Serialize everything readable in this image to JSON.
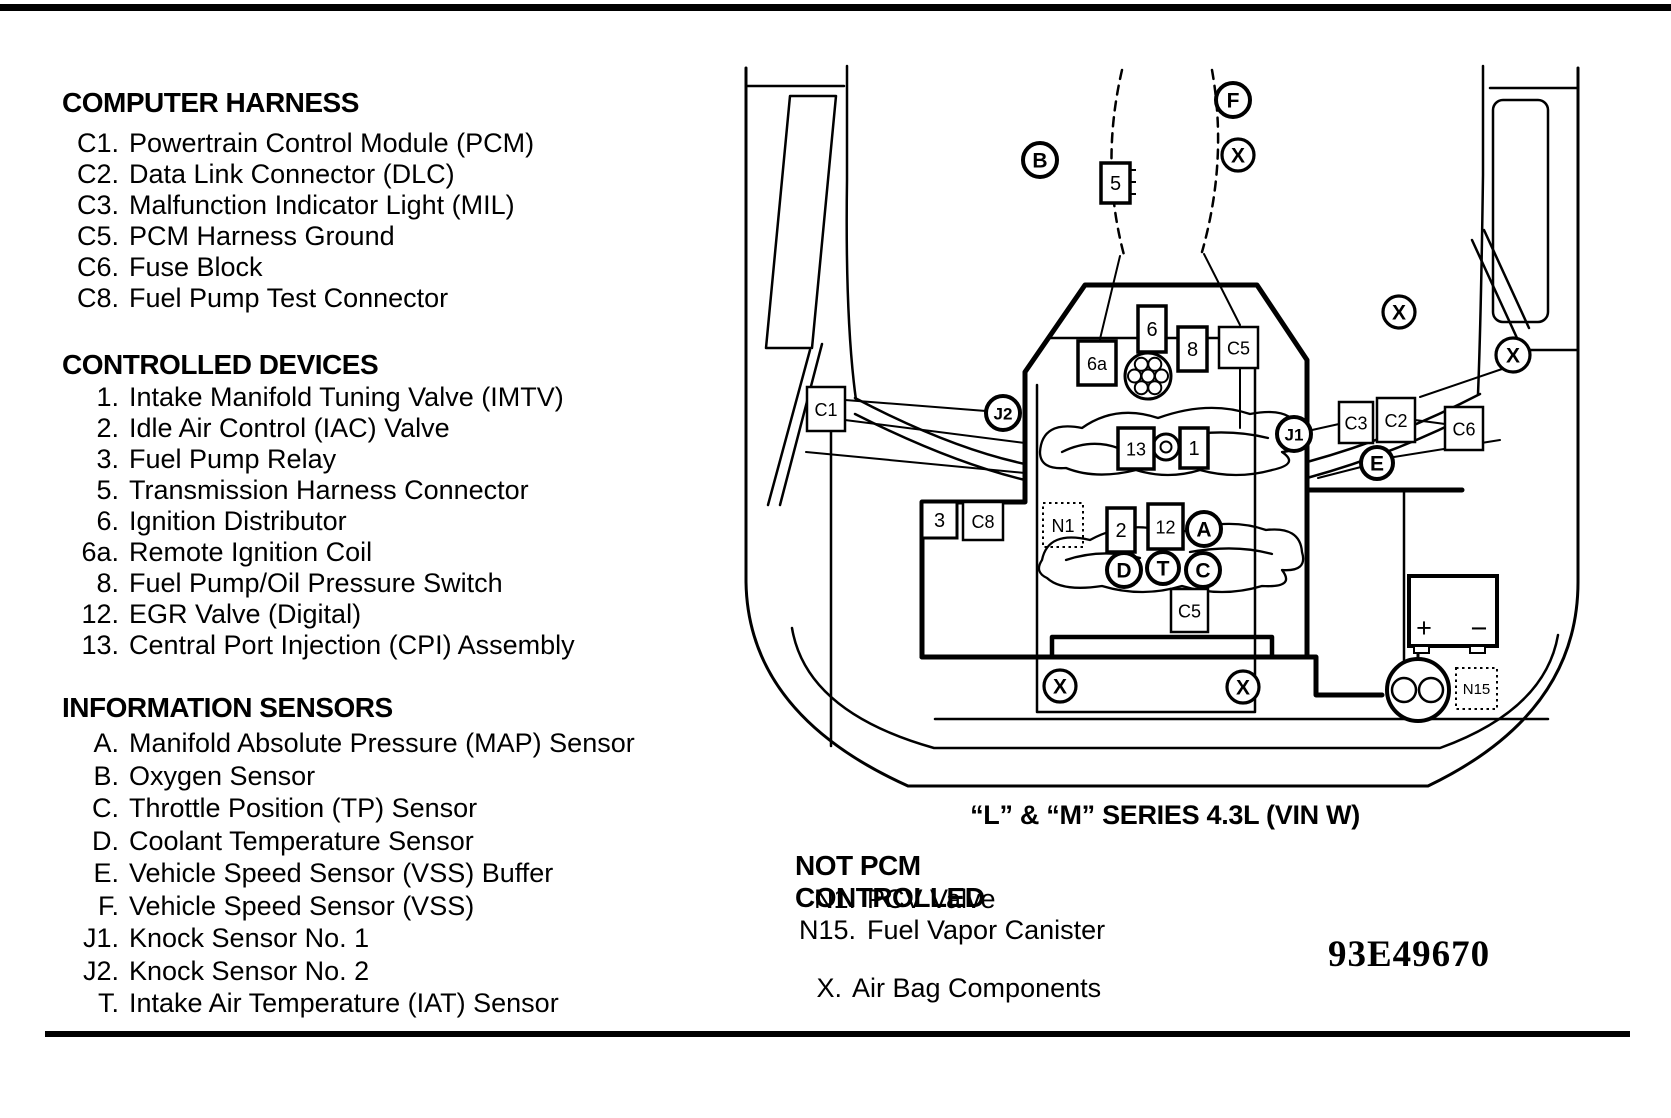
{
  "ink_color": "#000000",
  "paper_color": "#ffffff",
  "legend_left": {
    "sections": [
      {
        "title": "COMPUTER HARNESS",
        "items": [
          {
            "code": "C1.",
            "label": "Powertrain Control Module (PCM)"
          },
          {
            "code": "C2.",
            "label": "Data Link Connector (DLC)"
          },
          {
            "code": "C3.",
            "label": "Malfunction Indicator Light (MIL)"
          },
          {
            "code": "C5.",
            "label": "PCM Harness Ground"
          },
          {
            "code": "C6.",
            "label": "Fuse Block"
          },
          {
            "code": "C8.",
            "label": "Fuel Pump Test Connector"
          }
        ]
      },
      {
        "title": "CONTROLLED DEVICES",
        "items": [
          {
            "code": "1.",
            "label": "Intake Manifold Tuning Valve (IMTV)"
          },
          {
            "code": "2.",
            "label": "Idle Air Control (IAC) Valve"
          },
          {
            "code": "3.",
            "label": "Fuel Pump Relay"
          },
          {
            "code": "5.",
            "label": "Transmission Harness Connector"
          },
          {
            "code": "6.",
            "label": "Ignition Distributor"
          },
          {
            "code": "6a.",
            "label": "Remote Ignition Coil"
          },
          {
            "code": "8.",
            "label": "Fuel Pump/Oil Pressure Switch"
          },
          {
            "code": "12.",
            "label": "EGR Valve (Digital)"
          },
          {
            "code": "13.",
            "label": "Central Port Injection (CPI) Assembly"
          }
        ]
      },
      {
        "title": "INFORMATION SENSORS",
        "items": [
          {
            "code": "A.",
            "label": "Manifold Absolute Pressure (MAP) Sensor"
          },
          {
            "code": "B.",
            "label": "Oxygen Sensor"
          },
          {
            "code": "C.",
            "label": "Throttle Position (TP) Sensor"
          },
          {
            "code": "D.",
            "label": "Coolant Temperature Sensor"
          },
          {
            "code": "E.",
            "label": "Vehicle Speed Sensor (VSS) Buffer"
          },
          {
            "code": "F.",
            "label": "Vehicle Speed Sensor (VSS)"
          },
          {
            "code": "J1.",
            "label": "Knock Sensor No. 1"
          },
          {
            "code": "J2.",
            "label": "Knock Sensor No. 2"
          },
          {
            "code": "T.",
            "label": "Intake Air Temperature (IAT) Sensor"
          }
        ]
      }
    ]
  },
  "caption": "“L” & “M” SERIES 4.3L (VIN W)",
  "not_pcm": {
    "title": "NOT PCM CONTROLLED",
    "items": [
      {
        "code": "N1.",
        "label": "PCV Valve"
      },
      {
        "code": "N15.",
        "label": "Fuel Vapor Canister"
      }
    ],
    "airbag": {
      "code": "X.",
      "label": "Air Bag Components"
    }
  },
  "figure_number": "93E49670",
  "diagram": {
    "battery": {
      "plus": "+",
      "minus": "−"
    },
    "boxes": [
      {
        "label": "5",
        "x": 1101,
        "y": 163,
        "w": 29,
        "h": 40,
        "sw": 3.5
      },
      {
        "label": "6",
        "x": 1138,
        "y": 306,
        "w": 28,
        "h": 46,
        "sw": 3.5
      },
      {
        "label": "8",
        "x": 1178,
        "y": 327,
        "w": 29,
        "h": 44,
        "sw": 3.5
      },
      {
        "label": "C5",
        "x": 1219,
        "y": 327,
        "w": 39,
        "h": 41,
        "sw": 2.5
      },
      {
        "label": "6a",
        "x": 1078,
        "y": 341,
        "w": 38,
        "h": 44,
        "sw": 3.5
      },
      {
        "label": "C1",
        "x": 807,
        "y": 387,
        "w": 38,
        "h": 44,
        "sw": 2.5
      },
      {
        "label": "13",
        "x": 1118,
        "y": 428,
        "w": 36,
        "h": 41,
        "sw": 3.5
      },
      {
        "label": "1",
        "x": 1180,
        "y": 428,
        "w": 28,
        "h": 40,
        "sw": 3.5
      },
      {
        "label": "C3",
        "x": 1339,
        "y": 402,
        "w": 34,
        "h": 41,
        "sw": 2.5
      },
      {
        "label": "C2",
        "x": 1377,
        "y": 398,
        "w": 38,
        "h": 44,
        "sw": 2.5
      },
      {
        "label": "C6",
        "x": 1445,
        "y": 407,
        "w": 38,
        "h": 43,
        "sw": 2.5
      },
      {
        "label": "3",
        "x": 922,
        "y": 502,
        "w": 35,
        "h": 36,
        "sw": 3
      },
      {
        "label": "C8",
        "x": 963,
        "y": 502,
        "w": 40,
        "h": 38,
        "sw": 2.5
      },
      {
        "label": "2",
        "x": 1107,
        "y": 508,
        "w": 28,
        "h": 44,
        "sw": 3.5
      },
      {
        "label": "12",
        "x": 1148,
        "y": 504,
        "w": 35,
        "h": 45,
        "sw": 3.5
      },
      {
        "label": "C5",
        "x": 1171,
        "y": 589,
        "w": 37,
        "h": 43,
        "sw": 2.5
      }
    ],
    "dotted_boxes": [
      {
        "label": "N1",
        "x": 1043,
        "y": 503,
        "w": 40,
        "h": 44
      },
      {
        "label": "N15",
        "x": 1456,
        "y": 668,
        "w": 41,
        "h": 41
      }
    ],
    "circles": [
      {
        "label": "B",
        "x": 1040,
        "y": 160,
        "r": 17,
        "sw": 4
      },
      {
        "label": "F",
        "x": 1233,
        "y": 100,
        "r": 17,
        "sw": 4
      },
      {
        "label": "X",
        "x": 1238,
        "y": 155,
        "r": 16,
        "sw": 3.2
      },
      {
        "label": "X",
        "x": 1399,
        "y": 312,
        "r": 16,
        "sw": 3.2
      },
      {
        "label": "X",
        "x": 1513,
        "y": 355,
        "r": 17,
        "sw": 3.2
      },
      {
        "label": "J2",
        "x": 1003,
        "y": 413,
        "r": 17,
        "sw": 4
      },
      {
        "label": "J1",
        "x": 1294,
        "y": 434,
        "r": 17,
        "sw": 4
      },
      {
        "label": "E",
        "x": 1377,
        "y": 463,
        "r": 16,
        "sw": 4
      },
      {
        "label": "A",
        "x": 1204,
        "y": 529,
        "r": 17,
        "sw": 4
      },
      {
        "label": "D",
        "x": 1124,
        "y": 570,
        "r": 17,
        "sw": 4
      },
      {
        "label": "T",
        "x": 1163,
        "y": 568,
        "r": 16,
        "sw": 4
      },
      {
        "label": "C",
        "x": 1203,
        "y": 570,
        "r": 17,
        "sw": 4
      },
      {
        "label": "X",
        "x": 1060,
        "y": 686,
        "r": 16,
        "sw": 3.2
      },
      {
        "label": "X",
        "x": 1243,
        "y": 687,
        "r": 16,
        "sw": 3.2
      }
    ]
  }
}
